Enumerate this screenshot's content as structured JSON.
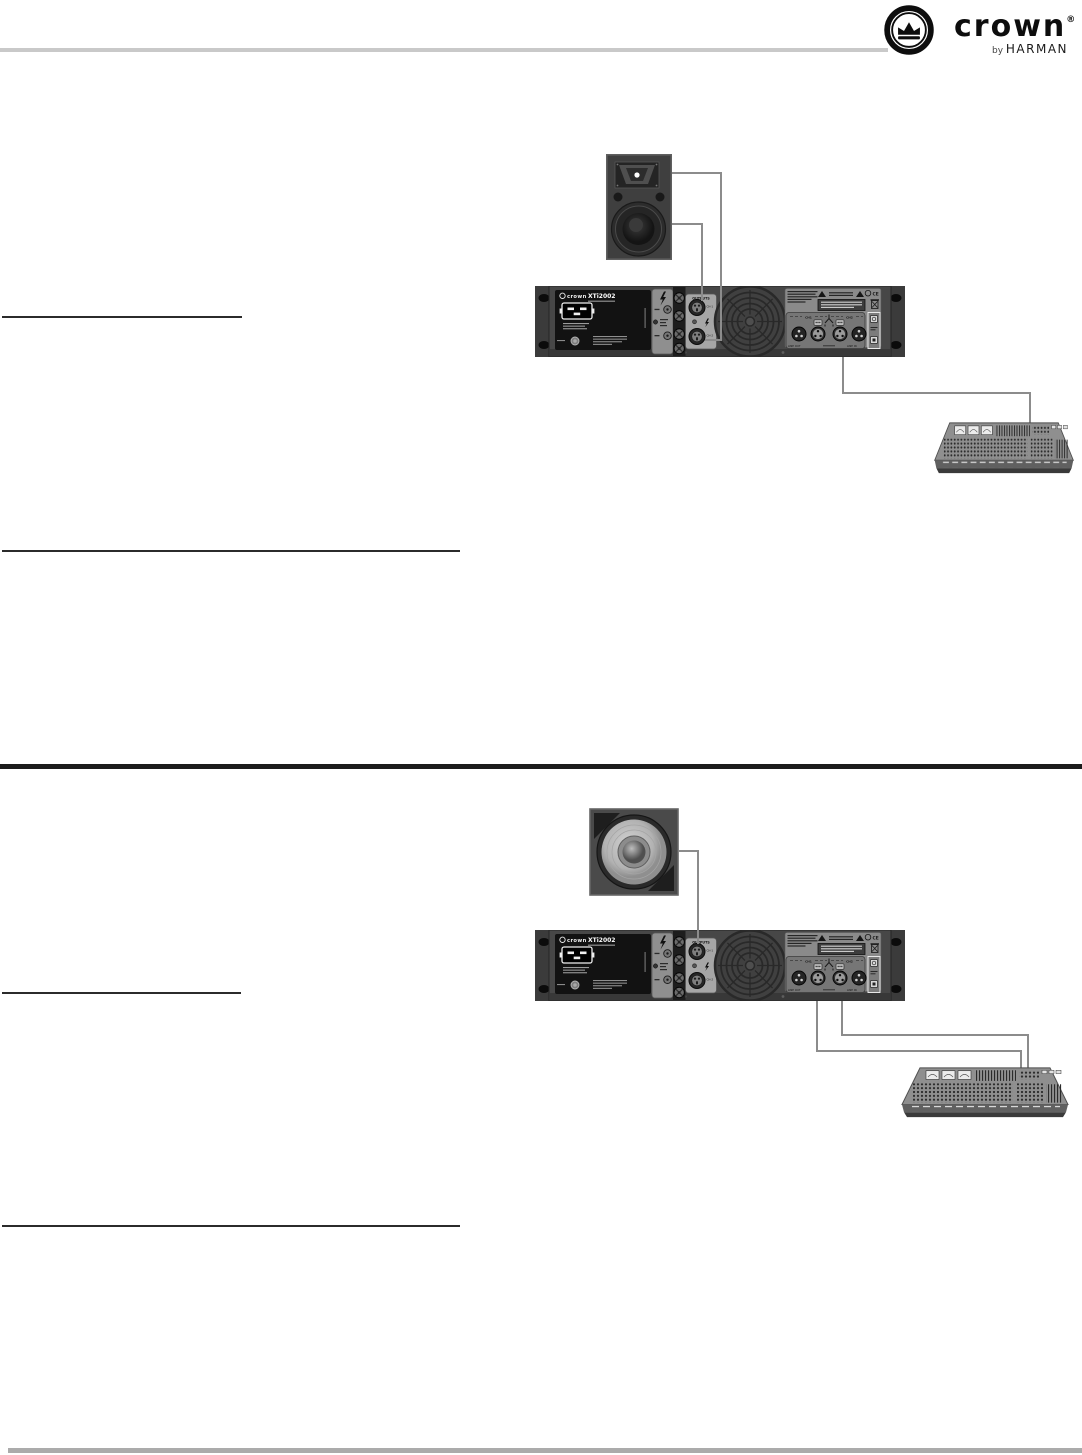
{
  "header": {
    "brand": "crown",
    "trademark": "®",
    "byline_prefix": "by ",
    "byline_brand": "HARMAN"
  },
  "amplifier": {
    "brand": "crown",
    "model": "XTi2002",
    "outputs_label": "OUTPUTS",
    "speakon_ch1_label": "CH-1",
    "speakon_ch2_label": "CH-2",
    "xlr_ch1_group_label": "CH1",
    "xlr_ch2_group_label": "CH2",
    "line_out_label": "LINE OUT",
    "line_in_label": "LINE IN",
    "ce_mark": "CE"
  },
  "colors": {
    "cable_gray": "#8c8c8c",
    "heading_rule_dark": "#2b2b2b",
    "top_rule_gray": "#c9c9c9",
    "bottom_rule_gray": "#ababab",
    "divider_black": "#1c1c1c"
  }
}
